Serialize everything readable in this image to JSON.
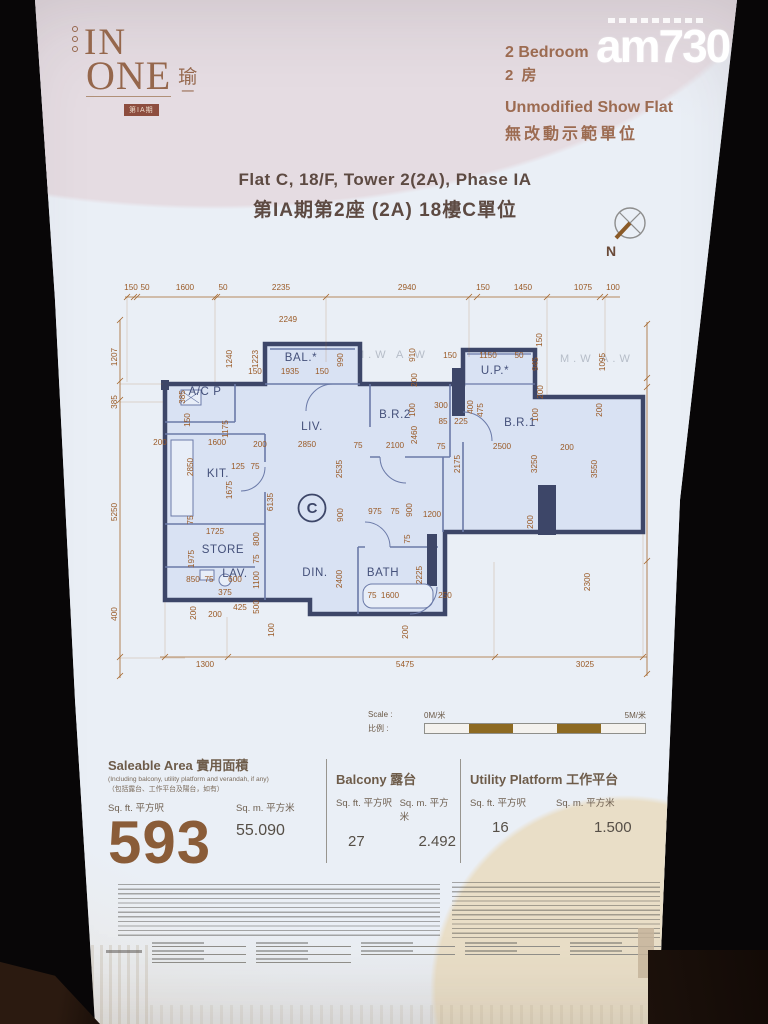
{
  "watermark": {
    "brand": "am730"
  },
  "header": {
    "logo": {
      "line1": "IN",
      "line2": "ONE",
      "zh1": "瑜",
      "zh2": "一",
      "badge": "第IA期"
    },
    "unit_type_en": "2 Bedroom",
    "unit_type_zh": "2 房",
    "showflat_en": "Unmodified Show Flat",
    "showflat_zh": "無改動示範單位"
  },
  "title": {
    "en": "Flat C, 18/F, Tower 2(2A), Phase IA",
    "zh": "第IA期第2座 (2A) 18樓C單位"
  },
  "compass": {
    "label": "N"
  },
  "floorplan": {
    "unit_label": "C",
    "watermark": "M.W   A.W",
    "rooms": [
      [
        "BAL.*",
        196,
        99
      ],
      [
        "A/C P",
        100,
        133
      ],
      [
        "LIV.",
        207,
        168
      ],
      [
        "B.R.2",
        290,
        156
      ],
      [
        "U.P.*",
        390,
        112
      ],
      [
        "B.R.1",
        415,
        164
      ],
      [
        "KIT.",
        113,
        215
      ],
      [
        "STORE",
        118,
        291
      ],
      [
        "LAV.",
        130,
        315
      ],
      [
        "DIN.",
        210,
        314
      ],
      [
        "BATH",
        278,
        314
      ]
    ],
    "dims": [
      [
        "150",
        26,
        28
      ],
      [
        "50",
        40,
        28
      ],
      [
        "1600",
        80,
        28
      ],
      [
        "50",
        118,
        28
      ],
      [
        "2235",
        176,
        28
      ],
      [
        "2940",
        302,
        28
      ],
      [
        "150",
        378,
        28
      ],
      [
        "1450",
        418,
        28
      ],
      [
        "1075",
        478,
        28
      ],
      [
        "100",
        508,
        28
      ],
      [
        "2249",
        183,
        60
      ],
      [
        "1240",
        127,
        97,
        -90
      ],
      [
        "1223",
        153,
        97,
        -90
      ],
      [
        "990",
        238,
        98,
        -90
      ],
      [
        "1935",
        185,
        112
      ],
      [
        "150",
        150,
        112
      ],
      [
        "150",
        217,
        112
      ],
      [
        "910",
        310,
        93,
        -90
      ],
      [
        "150",
        345,
        96
      ],
      [
        "1150",
        383,
        96
      ],
      [
        "50",
        414,
        96
      ],
      [
        "945",
        433,
        102,
        -90
      ],
      [
        "150",
        437,
        78,
        -90
      ],
      [
        "1095",
        500,
        100,
        -90
      ],
      [
        "200",
        312,
        118,
        -90
      ],
      [
        "200",
        438,
        130,
        -90
      ],
      [
        "385",
        80,
        135,
        -90
      ],
      [
        "150",
        85,
        158,
        -90
      ],
      [
        "1207",
        12,
        95,
        -90
      ],
      [
        "385",
        12,
        140,
        -90
      ],
      [
        "5250",
        12,
        250,
        -90
      ],
      [
        "400",
        12,
        352,
        -90
      ],
      [
        "200",
        55,
        183
      ],
      [
        "1600",
        112,
        183
      ],
      [
        "200",
        155,
        185
      ],
      [
        "2850",
        202,
        185
      ],
      [
        "75",
        253,
        186
      ],
      [
        "2100",
        290,
        186
      ],
      [
        "75",
        336,
        187
      ],
      [
        "2500",
        397,
        187
      ],
      [
        "200",
        462,
        188
      ],
      [
        "1175",
        123,
        167,
        -90
      ],
      [
        "2850",
        88,
        205,
        -90
      ],
      [
        "2535",
        237,
        207,
        -90
      ],
      [
        "2460",
        312,
        173,
        -90
      ],
      [
        "1675",
        127,
        228,
        -90
      ],
      [
        "6135",
        168,
        240,
        -90
      ],
      [
        "2175",
        355,
        202,
        -90
      ],
      [
        "3250",
        432,
        202,
        -90
      ],
      [
        "3550",
        492,
        207,
        -90
      ],
      [
        "100",
        310,
        148,
        -90
      ],
      [
        "300",
        336,
        146
      ],
      [
        "400",
        368,
        145,
        -90
      ],
      [
        "475",
        378,
        148,
        -90
      ],
      [
        "85",
        338,
        162
      ],
      [
        "225",
        356,
        162
      ],
      [
        "100",
        433,
        153,
        -90
      ],
      [
        "200",
        497,
        148,
        -90
      ],
      [
        "125",
        133,
        207
      ],
      [
        "75",
        150,
        207
      ],
      [
        "900",
        238,
        253,
        -90
      ],
      [
        "975",
        270,
        252
      ],
      [
        "75",
        290,
        252
      ],
      [
        "75",
        88,
        258,
        -90
      ],
      [
        "1725",
        110,
        272
      ],
      [
        "800",
        154,
        277,
        -90
      ],
      [
        "75",
        154,
        297,
        -90
      ],
      [
        "1975",
        89,
        297,
        -90
      ],
      [
        "1100",
        154,
        318,
        -90
      ],
      [
        "2400",
        237,
        317,
        -90
      ],
      [
        "850",
        88,
        320
      ],
      [
        "75",
        104,
        320
      ],
      [
        "600",
        130,
        320
      ],
      [
        "375",
        120,
        333
      ],
      [
        "425",
        135,
        348
      ],
      [
        "500",
        154,
        345,
        -90
      ],
      [
        "200",
        91,
        351,
        -90
      ],
      [
        "200",
        110,
        355
      ],
      [
        "75",
        267,
        336
      ],
      [
        "1600",
        285,
        336
      ],
      [
        "900",
        307,
        248,
        -90
      ],
      [
        "1200",
        327,
        255
      ],
      [
        "75",
        305,
        277,
        -90
      ],
      [
        "200",
        428,
        260,
        -90
      ],
      [
        "2300",
        485,
        320,
        -90
      ],
      [
        "2225",
        317,
        313,
        -90
      ],
      [
        "250",
        340,
        336
      ],
      [
        "200",
        303,
        370,
        -90
      ],
      [
        "100",
        169,
        368,
        -90
      ],
      [
        "1300",
        100,
        405
      ],
      [
        "5475",
        300,
        405
      ],
      [
        "3025",
        480,
        405
      ]
    ]
  },
  "scalebar": {
    "label_en": "Scale :",
    "label_zh": "比例 :",
    "start": "0M/米",
    "end": "5M/米"
  },
  "areas": {
    "saleable": {
      "title": "Saleable Area 實用面積",
      "note_en": "(Including balcony, utility platform and verandah, if any)",
      "note_zh": "（包括露台、工作平台及陽台，如有）",
      "sqft_label": "Sq. ft. 平方呎",
      "sqm_label": "Sq. m. 平方米",
      "sqft": "593",
      "sqm": "55.090"
    },
    "balcony": {
      "title": "Balcony 露台",
      "sqft_label": "Sq. ft. 平方呎",
      "sqm_label": "Sq. m. 平方米",
      "sqft": "27",
      "sqm": "2.492"
    },
    "utility": {
      "title": "Utility Platform 工作平台",
      "sqft_label": "Sq. ft. 平方呎",
      "sqm_label": "Sq. m. 平方米",
      "sqft": "16",
      "sqm": "1.500"
    }
  },
  "colors": {
    "accent_brown": "#8a5c38",
    "dim_orange": "#9a5a26",
    "wall_navy": "#3d4668",
    "plan_fill": "#d9e2f3",
    "scale_brown": "#8d6a22",
    "logo_brown": "#95674c"
  }
}
